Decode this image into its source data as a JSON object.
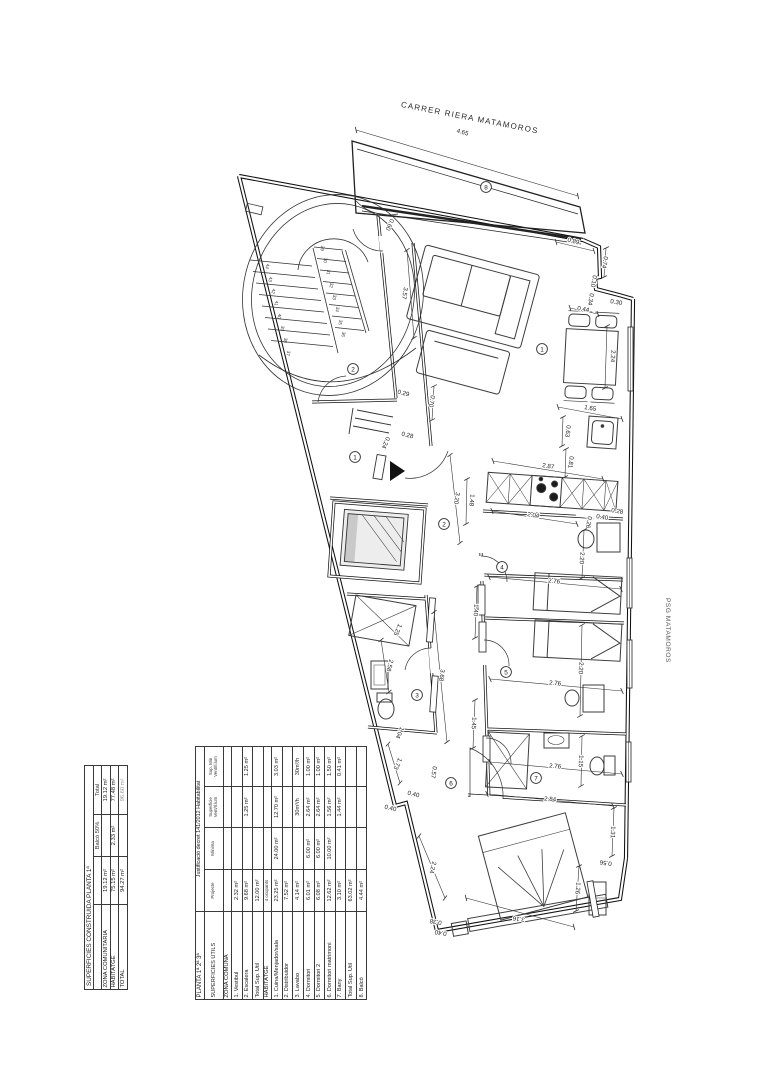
{
  "labels": {
    "street_top": "CARRER RIERA MATAMOROS",
    "street_right": "PSG MATAMOROS"
  },
  "tables": {
    "surfaces_util": {
      "title_left": "PLANTA 1ª 2ª 3ª",
      "title_right": "Justificació decret 141/2012 Habitabilitat",
      "columns": [
        "SUPERFICIES UTILS",
        "Projecte",
        "Mínima",
        "Superficie\nVent/Il.lum",
        "Sup. Min\nVent/Il.lum"
      ],
      "sections": [
        {
          "header": "ZONA COMUNA",
          "note": "",
          "rows": [
            [
              "1. Vestibul",
              "2.32 m²",
              "",
              "",
              ""
            ],
            [
              "2. Escalera",
              "9.68 m²",
              "",
              "1.25 m²",
              "1.25 m²"
            ],
            [
              "Total Sup. Util",
              "12.00 m²",
              "",
              "",
              ""
            ]
          ]
        },
        {
          "header": "HABITATGE",
          "note": "4 ocupants",
          "rows": [
            [
              "1. Cuina/Menjador/sala",
              "23.25 m²",
              "24.00 m²",
              "12.70 m²",
              "3.03 m²"
            ],
            [
              "2. Distribuidor",
              "7.52 m²",
              "",
              "",
              ""
            ],
            [
              "3. Lavabo",
              "4.14 m²",
              "",
              "30m³/h",
              "30m³/h"
            ],
            [
              "4. Dormitori",
              "6.01 m²",
              "6.00 m²",
              "2.64 m²",
              "1.00 m²"
            ],
            [
              "5. Dormitori 2",
              "6.08 m²",
              "6.00 m²",
              "2.64 m²",
              "1.00 m²"
            ],
            [
              "6. Dormitori matrimoni",
              "12.62 m²",
              "10.00 m²",
              "1.56 m²",
              "1.50 m²"
            ],
            [
              "7. Bany",
              "3.10 m²",
              "",
              "1.44 m²",
              "0.41 m²"
            ],
            [
              "Total Sup. Util",
              "63.02 m²",
              "",
              "",
              ""
            ],
            [
              "8. Balcó",
              "4.44 m²",
              "",
              "",
              ""
            ]
          ]
        }
      ]
    },
    "surfaces_built": {
      "title": "SUPERFICIES CONSTRUIDA PLANTA 1ª",
      "col_headers": [
        "",
        "",
        "Balcó 50%",
        "Total"
      ],
      "rows": [
        [
          "ZONA COMUNITARIA",
          "19.12 m²",
          "",
          "19.12 m²"
        ],
        [
          "HABITATGE",
          "75.15 m²",
          "2.33 m²",
          "77.48 m²"
        ],
        [
          "TOTAL",
          "94.27 m²",
          "",
          "96.60 m²"
        ]
      ]
    }
  },
  "plan": {
    "dimensions": [
      {
        "t": "4.65",
        "x": 462,
        "y": 134,
        "r": 16,
        "l": [
          356,
          130,
          578,
          196
        ]
      },
      {
        "t": "0.89",
        "x": 573,
        "y": 243,
        "r": 13,
        "l": [
          556,
          242,
          594,
          251
        ]
      },
      {
        "t": "0.74",
        "x": 603,
        "y": 262,
        "r": 100,
        "l": [
          606,
          248,
          604,
          277
        ]
      },
      {
        "t": "0.10",
        "x": 592,
        "y": 281,
        "r": 100
      },
      {
        "t": "0.34",
        "x": 589,
        "y": 299,
        "r": 100
      },
      {
        "t": "0.44",
        "x": 583,
        "y": 311,
        "r": 10,
        "l": [
          570,
          308,
          598,
          314
        ]
      },
      {
        "t": "0.30",
        "x": 616,
        "y": 304,
        "r": 10
      },
      {
        "t": "2.24",
        "x": 611,
        "y": 356,
        "r": 93,
        "l": [
          607,
          326,
          605,
          388
        ]
      },
      {
        "t": "1.65",
        "x": 590,
        "y": 410,
        "r": 9,
        "l": [
          558,
          407,
          622,
          419
        ]
      },
      {
        "t": "0.63",
        "x": 566,
        "y": 431,
        "r": 97,
        "l": [
          563,
          417,
          562,
          446
        ]
      },
      {
        "t": "0.81",
        "x": 569,
        "y": 462,
        "r": 97,
        "l": [
          566,
          449,
          565,
          477
        ]
      },
      {
        "t": "2.87",
        "x": 548,
        "y": 468,
        "r": 9,
        "l": [
          493,
          461,
          603,
          479
        ]
      },
      {
        "t": "1.48",
        "x": 470,
        "y": 500,
        "r": 95,
        "l": [
          467,
          479,
          466,
          524
        ]
      },
      {
        "t": "2.04",
        "x": 533,
        "y": 517,
        "r": 9,
        "l": [
          492,
          511,
          577,
          524
        ]
      },
      {
        "t": "0.26",
        "x": 587,
        "y": 522,
        "r": 100
      },
      {
        "t": "0.40",
        "x": 602,
        "y": 519,
        "r": 9
      },
      {
        "t": "0.28",
        "x": 617,
        "y": 513,
        "r": 9
      },
      {
        "t": "2.20",
        "x": 580,
        "y": 558,
        "r": 93,
        "l": [
          584,
          530,
          582,
          578
        ]
      },
      {
        "t": "2.76",
        "x": 554,
        "y": 583,
        "r": 5,
        "l": [
          489,
          577,
          621,
          589
        ]
      },
      {
        "t": "2.20",
        "x": 579,
        "y": 668,
        "r": 93,
        "l": [
          582,
          625,
          580,
          716
        ]
      },
      {
        "t": "2.76",
        "x": 555,
        "y": 685,
        "r": 5,
        "l": [
          490,
          679,
          622,
          691
        ]
      },
      {
        "t": "1.15",
        "x": 579,
        "y": 761,
        "r": 93,
        "l": [
          582,
          736,
          581,
          786
        ]
      },
      {
        "t": "2.76",
        "x": 555,
        "y": 768,
        "r": 5,
        "l": [
          490,
          762,
          622,
          774
        ]
      },
      {
        "t": "1.40",
        "x": 474,
        "y": 610,
        "r": 93,
        "l": [
          477,
          586,
          475,
          638
        ]
      },
      {
        "t": "1.45",
        "x": 472,
        "y": 723,
        "r": 93,
        "l": [
          475,
          700,
          473,
          748
        ]
      },
      {
        "t": "3.68",
        "x": 440,
        "y": 675,
        "r": 97,
        "l": [
          434,
          612,
          447,
          742
        ]
      },
      {
        "t": "3.20",
        "x": 455,
        "y": 498,
        "r": 99,
        "l": [
          450,
          455,
          460,
          543
        ]
      },
      {
        "t": "1.25",
        "x": 396,
        "y": 629,
        "r": 113
      },
      {
        "t": "2.58",
        "x": 388,
        "y": 665,
        "r": 104,
        "l": [
          381,
          640,
          389,
          692
        ]
      },
      {
        "t": "1.04",
        "x": 398,
        "y": 732,
        "r": 113
      },
      {
        "t": "1.73",
        "x": 396,
        "y": 763,
        "r": 113,
        "l": [
          388,
          744,
          400,
          783
        ]
      },
      {
        "t": "0.40",
        "x": 413,
        "y": 796,
        "r": 13
      },
      {
        "t": "0.40",
        "x": 390,
        "y": 810,
        "r": 13
      },
      {
        "t": "0.57",
        "x": 432,
        "y": 772,
        "r": 100
      },
      {
        "t": "2.24",
        "x": 431,
        "y": 867,
        "r": 104,
        "l": [
          419,
          836,
          445,
          898
        ]
      },
      {
        "t": "0.38",
        "x": 436,
        "y": 920,
        "r": 190
      },
      {
        "t": "0.40",
        "x": 441,
        "y": 931,
        "r": 190
      },
      {
        "t": "3.16",
        "x": 519,
        "y": 917,
        "r": 188,
        "l": [
          466,
          898,
          574,
          927
        ]
      },
      {
        "t": "1.26",
        "x": 576,
        "y": 888,
        "r": 95,
        "l": [
          579,
          866,
          576,
          911
        ]
      },
      {
        "t": "0.56",
        "x": 606,
        "y": 861,
        "r": 188
      },
      {
        "t": "1.31",
        "x": 611,
        "y": 832,
        "r": 93,
        "l": [
          614,
          808,
          612,
          856
        ]
      },
      {
        "t": "2.84",
        "x": 550,
        "y": 801,
        "r": 5,
        "l": [
          487,
          794,
          613,
          806
        ]
      },
      {
        "t": "3.57",
        "x": 403,
        "y": 293,
        "r": 100,
        "l": [
          407,
          250,
          414,
          338
        ]
      },
      {
        "t": "0.60",
        "x": 388,
        "y": 224,
        "r": 113
      },
      {
        "t": "0.29",
        "x": 403,
        "y": 395,
        "r": 13
      },
      {
        "t": "0.70",
        "x": 430,
        "y": 401,
        "r": 100,
        "l": [
          434,
          386,
          432,
          420
        ]
      },
      {
        "t": "0.28",
        "x": 407,
        "y": 437,
        "r": 13
      },
      {
        "t": "0.24",
        "x": 384,
        "y": 442,
        "r": 113
      }
    ],
    "room_markers": [
      {
        "n": "8",
        "x": 486,
        "y": 187
      },
      {
        "n": "1",
        "x": 542,
        "y": 349
      },
      {
        "n": "2",
        "x": 353,
        "y": 369
      },
      {
        "n": "1",
        "x": 355,
        "y": 457
      },
      {
        "n": "2",
        "x": 444,
        "y": 524
      },
      {
        "n": "4",
        "x": 502,
        "y": 567
      },
      {
        "n": "3",
        "x": 417,
        "y": 695
      },
      {
        "n": "5",
        "x": 506,
        "y": 672
      },
      {
        "n": "7",
        "x": 536,
        "y": 778
      },
      {
        "n": "6",
        "x": 451,
        "y": 783
      }
    ],
    "stair_numbers": [
      {
        "n": "44",
        "x": 266,
        "y": 266
      },
      {
        "n": "43",
        "x": 269,
        "y": 279
      },
      {
        "n": "42",
        "x": 272,
        "y": 291
      },
      {
        "n": "41",
        "x": 275,
        "y": 303
      },
      {
        "n": "40",
        "x": 278,
        "y": 316
      },
      {
        "n": "39",
        "x": 281,
        "y": 328
      },
      {
        "n": "38",
        "x": 284,
        "y": 340
      },
      {
        "n": "37",
        "x": 287,
        "y": 353
      },
      {
        "n": "29",
        "x": 321,
        "y": 248
      },
      {
        "n": "30",
        "x": 324,
        "y": 260
      },
      {
        "n": "31",
        "x": 327,
        "y": 272
      },
      {
        "n": "32",
        "x": 330,
        "y": 285
      },
      {
        "n": "33",
        "x": 333,
        "y": 297
      },
      {
        "n": "34",
        "x": 336,
        "y": 309
      },
      {
        "n": "35",
        "x": 339,
        "y": 322
      },
      {
        "n": "36",
        "x": 342,
        "y": 334
      }
    ]
  }
}
